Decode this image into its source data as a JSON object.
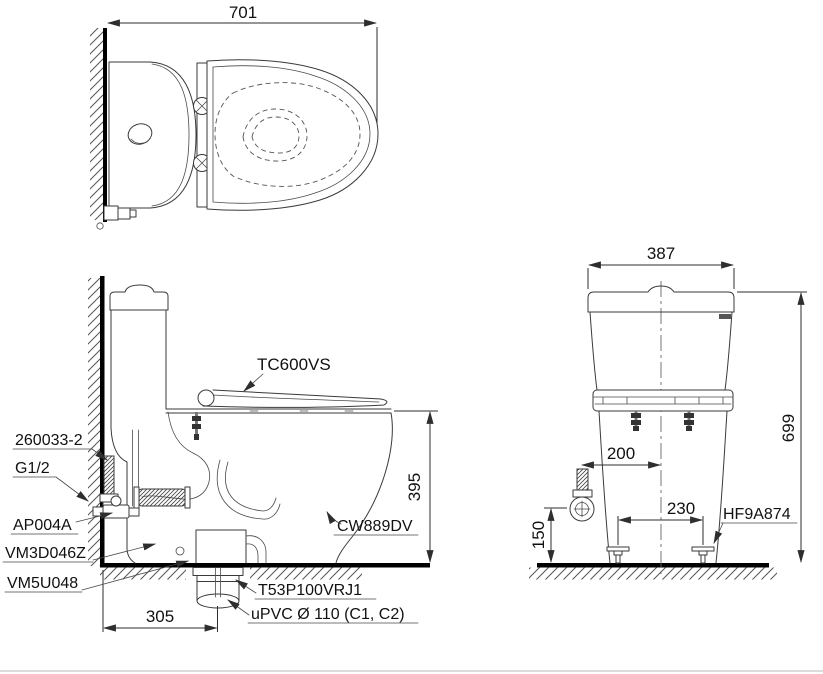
{
  "title": "toilet-installation-drawing",
  "colors": {
    "line": "#3a3a3a",
    "heavy": "#000000",
    "background": "#ffffff"
  },
  "top_view": {
    "dim_width": "701"
  },
  "side_view": {
    "dim_height_seat": "395",
    "dim_drain_offset": "305",
    "label_seat": "TC600VS",
    "label_bowl": "CW889DV",
    "label_tank_bolt": "260033-2",
    "label_supply_thread": "G1/2",
    "label_stop_valve": "AP004A",
    "label_inlet_valve": "VM3D046Z",
    "label_outlet_gasket": "VM5U048",
    "label_flange": "T53P100VRJ1",
    "label_drain_pipe": "uPVC Ø 110 (C1, C2)"
  },
  "front_view": {
    "dim_width": "387",
    "dim_height": "699",
    "dim_supply_offset": "200",
    "dim_bolt_spacing": "230",
    "dim_supply_height": "150",
    "label_floor_bolt": "HF9A874"
  }
}
